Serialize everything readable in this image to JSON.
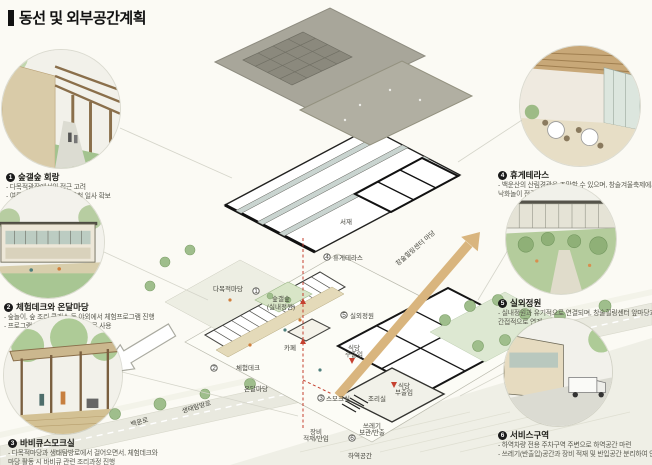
{
  "title": "동선 및 외부공간계획",
  "callouts": {
    "left": [
      {
        "num": "1",
        "heading": "숲갤숲 회랑",
        "lines": [
          "- 다목적광장에서의 접근 고려",
          "- 여름철 차양 역할 및 겨울철 일사 확보"
        ]
      },
      {
        "num": "2",
        "heading": "체험데크와 온달마당",
        "lines": [
          "- 숲놀이, 숲 조리 클래스 등 야외에서 체험프로그램 진행",
          "- 프로그램 미진행시 휴게 공간으로 사용"
        ]
      },
      {
        "num": "3",
        "heading": "바비큐스모크실",
        "lines": [
          "- 다목적마당과 생태탐방로에서 걸어오면서, 체험데크와",
          "  마당 활동 시 바비큐 관련 조리과정 진행"
        ]
      }
    ],
    "right": [
      {
        "num": "4",
        "heading": "휴게테라스",
        "lines": [
          "- 백운산의 산림경관을 조망할 수 있으며, 창술겨울축제에서 열리는",
          "  낙화놀이 전경가능"
        ]
      },
      {
        "num": "5",
        "heading": "실외정원",
        "lines": [
          "- 실내정원과 유기적으로 연결되며, 창술힐링센터 앞마당과",
          "  간접적으로 연계"
        ]
      },
      {
        "num": "6",
        "heading": "서비스구역",
        "lines": [
          "- 하역차량 전용 주차구역 주변으로 하역공간 마련",
          "- 쓰레기(반출입)공간과 장비 적재 및 반입공간 분리하여 인접배치"
        ]
      }
    ]
  },
  "plan": {
    "study": "서재",
    "terrace": "휴게테라스",
    "indoor_garden_1": "숲갤숲",
    "indoor_garden_2": "(실내정원)",
    "outdoor_garden": "실외정원",
    "cafe": "카페",
    "multipurpose_yard": "다목적마당",
    "experience_deck": "체험데크",
    "ondal_yard": "온달마당",
    "smoke_room": "스모크실",
    "kitchen": "조리실",
    "rest_main_1": "식당",
    "rest_main_2": "주출입",
    "rest_sub_1": "식당",
    "rest_sub_2": "부출입",
    "equip_1": "장비",
    "equip_2": "적재/반입",
    "trash_1": "쓰레기",
    "trash_2": "보관/반출",
    "loading": "하역공간",
    "road_main": "백운로",
    "road_eco": "생태탐방로",
    "arrow_label": "창술힐링센터 마당",
    "markers": {
      "m1": "1",
      "m2": "2",
      "m3": "3",
      "m4": "4",
      "m5": "5",
      "m6": "6"
    }
  },
  "colors": {
    "accent_arrow": "#d9b57e",
    "circulation_red": "#c5402f",
    "roof_grey": "#a8a69a",
    "tree_green": "#9fbe8c"
  }
}
